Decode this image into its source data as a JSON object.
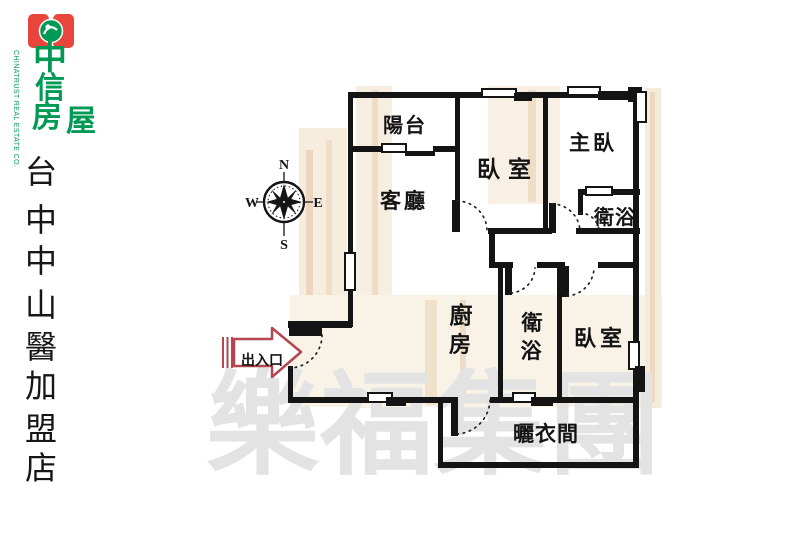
{
  "logo": {
    "company_en": "CHINATRUST REAL ESTATE CO.",
    "name_chars": [
      "中",
      "信",
      "房",
      "屋"
    ],
    "green": "#009a55",
    "red": "#e8453c"
  },
  "store": {
    "chars": [
      "台",
      "中",
      "中",
      "山",
      "醫",
      "加",
      "盟",
      "店"
    ]
  },
  "compass": {
    "n": "N",
    "s": "S",
    "e": "E",
    "w": "W"
  },
  "plan": {
    "balcony": "陽台",
    "living": "客廳",
    "bedroom1": "臥室",
    "master": "主臥",
    "bath1": "衛浴",
    "kitchen_chars": [
      "廚",
      "房"
    ],
    "bath2_chars": [
      "衛",
      "浴"
    ],
    "bedroom2": "臥室",
    "drying": "曬衣間",
    "entrance": "出入口",
    "wall_color": "#141414",
    "arrow_color": "#b5454e"
  },
  "watermark": {
    "text": "樂福集團",
    "color": "#e3e3e3"
  }
}
